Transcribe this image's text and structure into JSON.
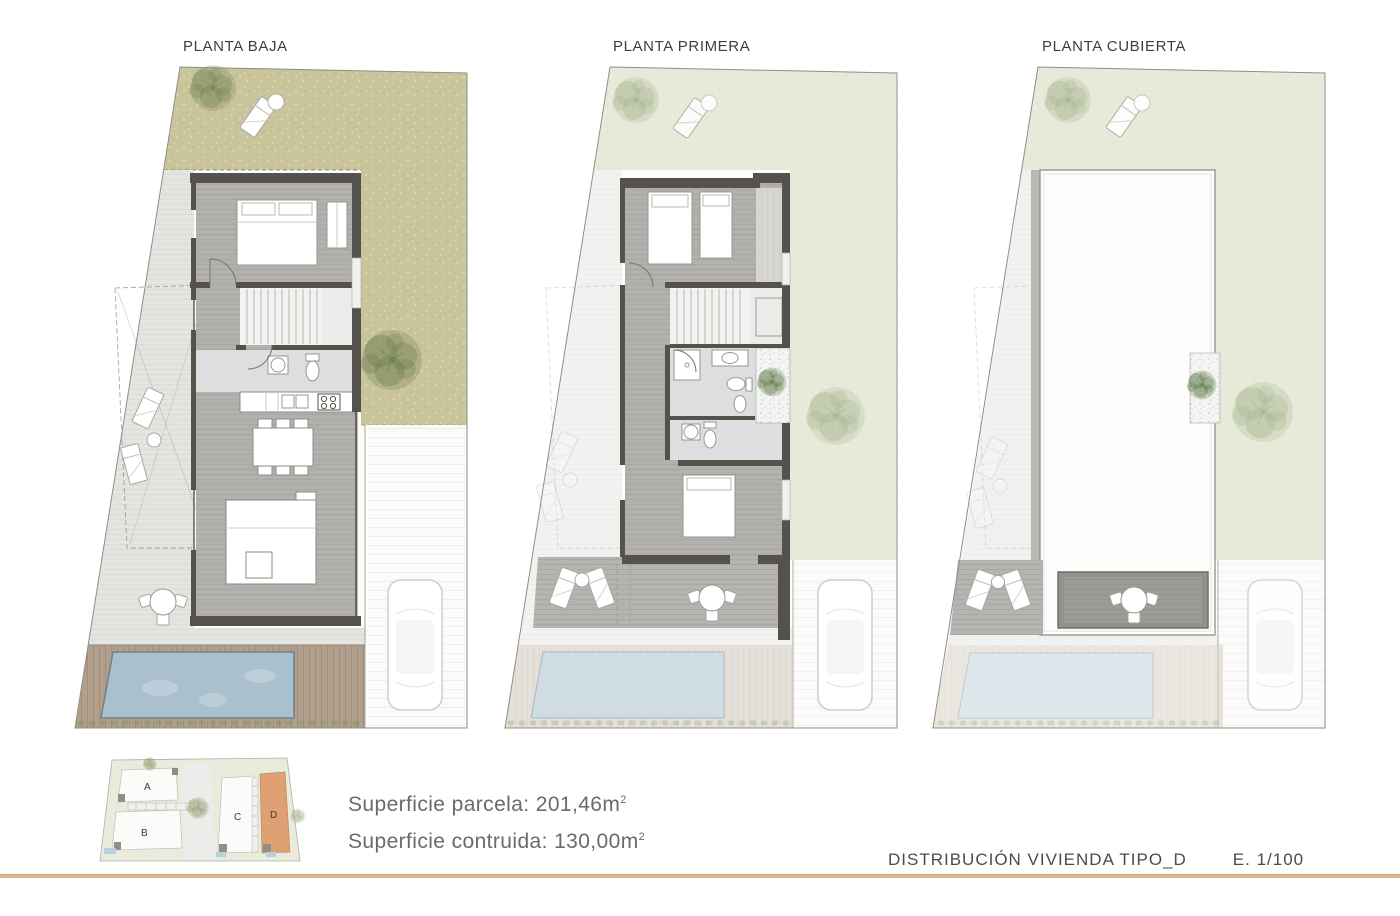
{
  "panels": [
    {
      "title": "PLANTA BAJA"
    },
    {
      "title": "PLANTA PRIMERA"
    },
    {
      "title": "PLANTA CUBIERTA"
    }
  ],
  "key_plan": {
    "plots": [
      "A",
      "B",
      "C",
      "D"
    ],
    "highlighted_plot": "D"
  },
  "summary": {
    "rows": [
      {
        "label": "Superficie parcela: 201,46m",
        "sup": "2"
      },
      {
        "label": "Superficie contruida: 130,00m",
        "sup": "2"
      }
    ]
  },
  "footer": {
    "title": "DISTRIBUCIÓN VIVIENDA TIPO_D",
    "scale": "E. 1/100"
  },
  "colors": {
    "grass_ground_floor": "#c9c49a",
    "grass_pale": "#e8ead9",
    "paving": "#e4e4e1",
    "wall": "#55524c",
    "wood_floor": "#b2b1ae",
    "bath_floor": "#dcdee0",
    "pool": "#a9c1ce",
    "pool_faded": "#d6e2e9",
    "wood_deck": "#b19e8b",
    "terrace_deck": "#b5b4b0",
    "accent_plot_d": "#dfa173",
    "rule_gold": "#d8bc90"
  }
}
